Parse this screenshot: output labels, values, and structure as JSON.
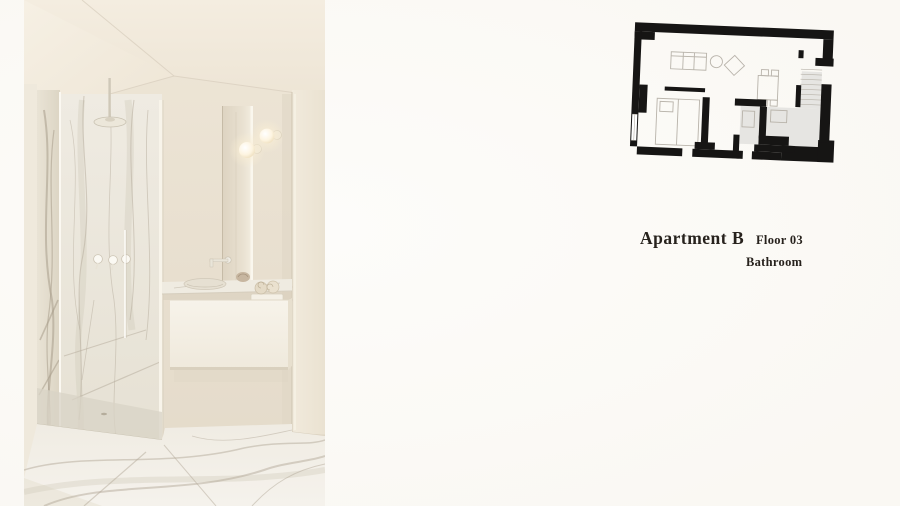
{
  "header": {
    "title": "Apartment B",
    "floor_label": "Floor 03",
    "room_label": "Bathroom"
  },
  "colors": {
    "page_bg": "#fcfbf8",
    "text": "#27221d",
    "plan_wall": "#161514",
    "plan_shade": "#e6e5e2",
    "plan_line": "#b8b3aa",
    "photo_wall": "#e9e1d2",
    "photo_ceiling": "#f2ebde",
    "photo_marble": "#edeae1",
    "photo_floor": "#f3f0e9",
    "lamp_glow": "#fff3d6"
  }
}
